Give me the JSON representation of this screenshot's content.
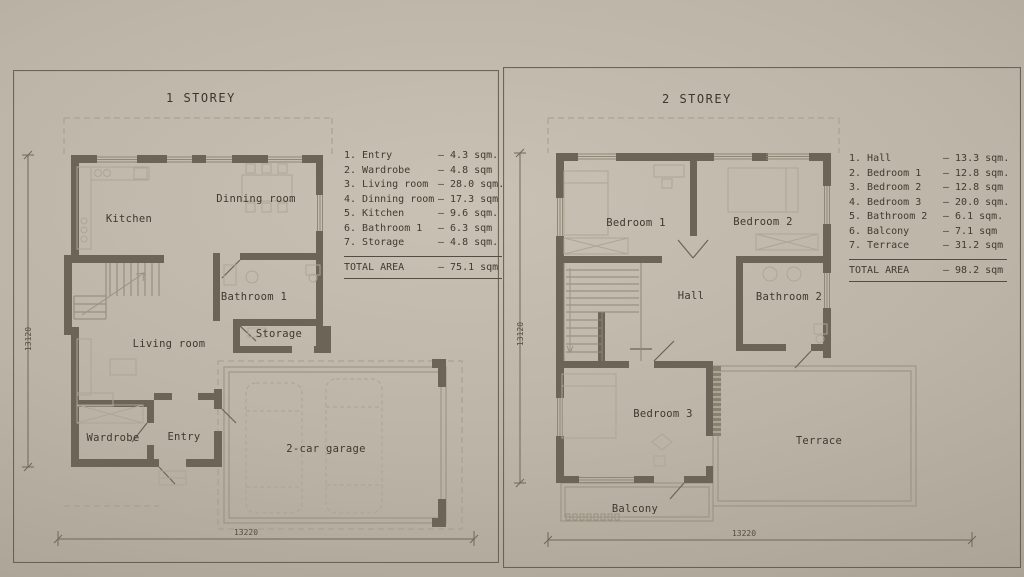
{
  "plans": [
    {
      "title": "1 STOREY",
      "legend": [
        {
          "label": "1. Entry",
          "value": "– 4.3 sqm."
        },
        {
          "label": "2. Wardrobe",
          "value": "– 4.8 sqm"
        },
        {
          "label": "3. Living room",
          "value": "– 28.0 sqm."
        },
        {
          "label": "4. Dinning room",
          "value": "– 17.3 sqm"
        },
        {
          "label": "5. Kitchen",
          "value": "– 9.6 sqm."
        },
        {
          "label": "6. Bathroom 1",
          "value": "– 6.3 sqm"
        },
        {
          "label": "7. Storage",
          "value": "– 4.8 sqm."
        }
      ],
      "total_label": "TOTAL AREA",
      "total_value": "– 75.1 sqm",
      "rooms": {
        "kitchen": "Kitchen",
        "dinning": "Dinning room",
        "bathroom1": "Bathroom 1",
        "storage": "Storage",
        "living": "Living room",
        "wardrobe": "Wardrobe",
        "entry": "Entry",
        "garage": "2-car garage"
      },
      "dims": {
        "width": "13220",
        "height": "13120"
      }
    },
    {
      "title": "2 STOREY",
      "legend": [
        {
          "label": "1. Hall",
          "value": "– 13.3 sqm."
        },
        {
          "label": "2. Bedroom 1",
          "value": "– 12.8 sqm."
        },
        {
          "label": "3. Bedroom 2",
          "value": "– 12.8 sqm"
        },
        {
          "label": "4. Bedroom 3",
          "value": "– 20.0 sqm."
        },
        {
          "label": "5. Bathroom 2",
          "value": "– 6.1 sqm."
        },
        {
          "label": "6. Balcony",
          "value": "– 7.1 sqm"
        },
        {
          "label": "7. Terrace",
          "value": "– 31.2 sqm"
        }
      ],
      "total_label": "TOTAL AREA",
      "total_value": "– 98.2 sqm",
      "rooms": {
        "bedroom1": "Bedroom 1",
        "bedroom2": "Bedroom 2",
        "hall": "Hall",
        "bathroom2": "Bathroom 2",
        "bedroom3": "Bedroom 3",
        "balcony": "Balcony",
        "terrace": "Terrace"
      },
      "dims": {
        "width": "13220",
        "height": "13120"
      }
    }
  ],
  "colors": {
    "wall": "#6b6457",
    "paper": "#bcb4a6",
    "ink": "#3e392f"
  }
}
